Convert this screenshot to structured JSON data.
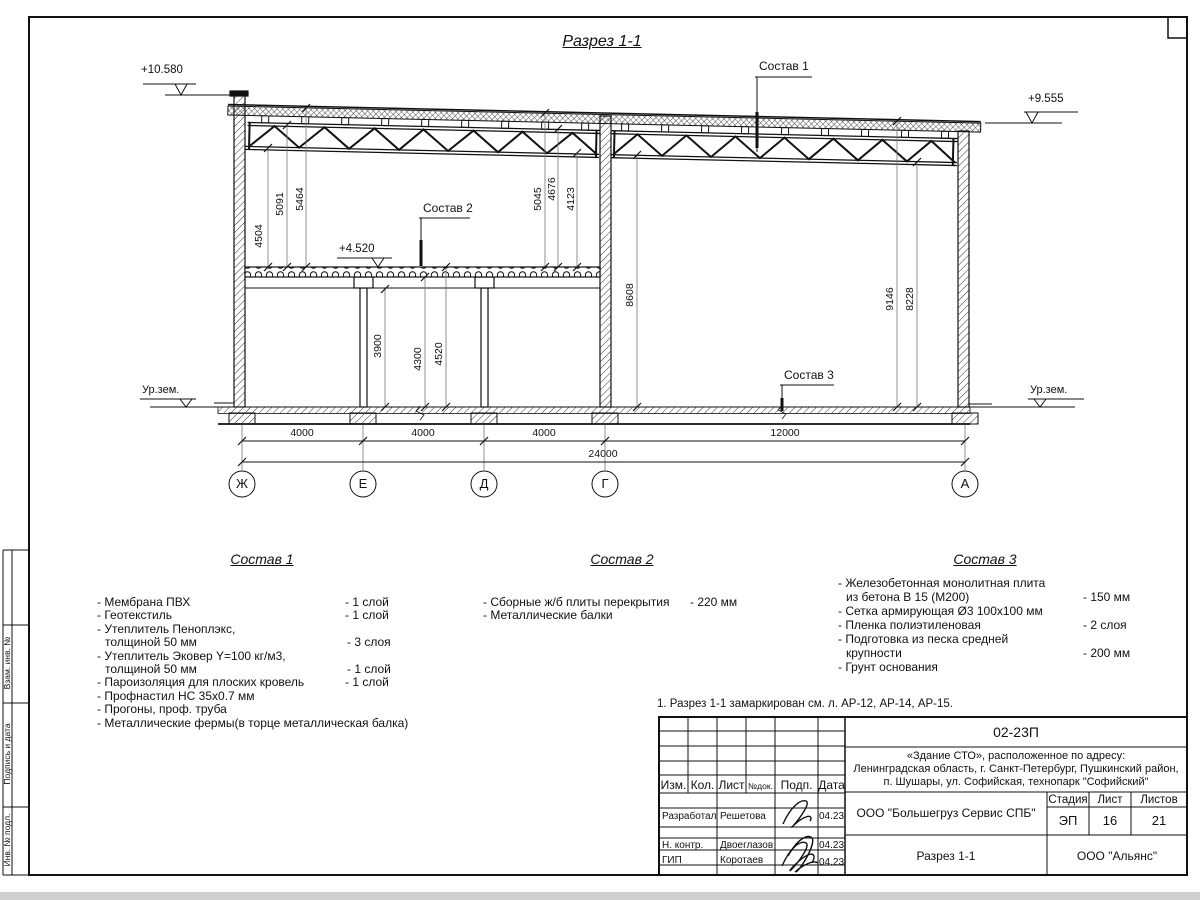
{
  "drawing": {
    "title": "Разрез 1-1",
    "note": "1. Разрез 1-1 замаркирован см. л. АР-12, АР-14, АР-15.",
    "elevations": {
      "top_left": "+10.580",
      "top_right": "+9.555",
      "mezzanine": "+4.520",
      "ground_left": "Ур.зем.",
      "ground_right": "Ур.зем."
    },
    "callouts": [
      "Состав 1",
      "Состав 2",
      "Состав 3"
    ],
    "dims": {
      "v": [
        "4504",
        "5091",
        "5464",
        "5045",
        "4676",
        "4123",
        "3900",
        "4300",
        "4520",
        "8608",
        "9146",
        "8228"
      ],
      "h": [
        "4000",
        "4000",
        "4000",
        "12000",
        "24000"
      ]
    },
    "axes": [
      "Ж",
      "Е",
      "Д",
      "Г",
      "А"
    ]
  },
  "compositions": [
    {
      "heading": "Состав 1",
      "items": [
        {
          "n": "- Мембрана ПВХ",
          "q": "- 1 слой"
        },
        {
          "n": "- Геотекстиль",
          "q": "- 1 слой"
        },
        {
          "n": "- Утеплитель Пеноплэкс,",
          "q": ""
        },
        {
          "n": "толщиной 50 мм",
          "q": "- 3 слоя"
        },
        {
          "n": "- Утеплитель Эковер Y=100 кг/м3,",
          "q": ""
        },
        {
          "n": "толщиной 50 мм",
          "q": "- 1 слой"
        },
        {
          "n": "- Пароизоляция для плоских кровель",
          "q": "- 1 слой"
        },
        {
          "n": "- Профнастил НС 35х0.7 мм",
          "q": ""
        },
        {
          "n": "- Прогоны, проф. труба",
          "q": ""
        },
        {
          "n": "- Металлические фермы(в торце металлическая балка)",
          "q": ""
        }
      ]
    },
    {
      "heading": "Состав 2",
      "items": [
        {
          "n": "- Сборные ж/б плиты перекрытия",
          "q": "- 220 мм"
        },
        {
          "n": "- Металлические балки",
          "q": ""
        }
      ]
    },
    {
      "heading": "Состав 3",
      "items": [
        {
          "n": "- Железобетонная  монолитная плита",
          "q": ""
        },
        {
          "n": "из бетона В 15 (М200)",
          "q": "- 150 мм"
        },
        {
          "n": "- Сетка армирующая Ø3 100х100 мм",
          "q": ""
        },
        {
          "n": "- Пленка полиэтиленовая",
          "q": "-  2 слоя"
        },
        {
          "n": "- Подготовка из песка средней",
          "q": ""
        },
        {
          "n": "крупности",
          "q": "- 200 мм"
        },
        {
          "n": "- Грунт основания",
          "q": ""
        }
      ]
    }
  ],
  "margin_labels": [
    "Взам. инв. №",
    "Подпись и дата",
    "Инв. № подл."
  ],
  "title_block": {
    "doc_number": "02-23П",
    "object_line1": "«Здание СТО», расположенное по адресу:",
    "object_line2": "Ленинградская область, г. Санкт-Петербург, Пушкинский район,",
    "object_line3": "п. Шушары, ул. Софийская, технопарк \"Софийский\"",
    "columns": {
      "izm": "Изм.",
      "kol": "Кол.",
      "list": "Лист",
      "ndok": "№док.",
      "podp": "Подп.",
      "data": "Дата"
    },
    "stage_label": "Стадия",
    "sheet_label": "Лист",
    "sheets_label": "Листов",
    "stage": "ЭП",
    "sheet": "16",
    "sheets": "21",
    "contractor": "ООО \"Большегруз Сервис СПБ\"",
    "drawing_name": "Разрез 1-1",
    "company": "ООО \"Альянс\"",
    "rows": [
      {
        "role": "Разработал",
        "name": "Решетова",
        "date": "04.23"
      },
      {
        "role": "Н. контр.",
        "name": "Двоеглазов",
        "date": "04.23"
      },
      {
        "role": "ГИП",
        "name": "Коротаев",
        "date": "04.23"
      }
    ]
  }
}
